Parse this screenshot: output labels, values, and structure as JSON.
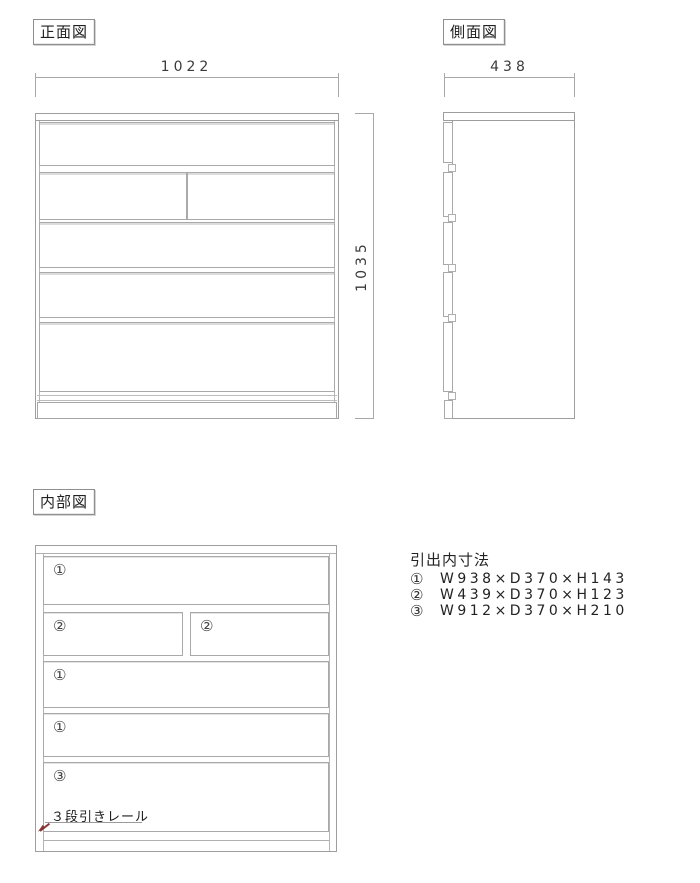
{
  "colors": {
    "line": "#a8a8a8",
    "text": "#333333",
    "leader_arrow": "#8b3333",
    "background": "#ffffff"
  },
  "front_view": {
    "label": "正面図",
    "width_dim": "1022",
    "height_dim": "1035"
  },
  "side_view": {
    "label": "側面図",
    "depth_dim": "438"
  },
  "internal_view": {
    "label": "内部図",
    "row_labels": [
      [
        "①"
      ],
      [
        "②",
        "②"
      ],
      [
        "①"
      ],
      [
        "①"
      ],
      [
        "③"
      ]
    ],
    "annotation": "３段引きレール"
  },
  "legend": {
    "title": "引出内寸法",
    "items": [
      {
        "num": "①",
        "dims": "W938×D370×H143"
      },
      {
        "num": "②",
        "dims": "W439×D370×H123"
      },
      {
        "num": "③",
        "dims": "W912×D370×H210"
      }
    ]
  }
}
